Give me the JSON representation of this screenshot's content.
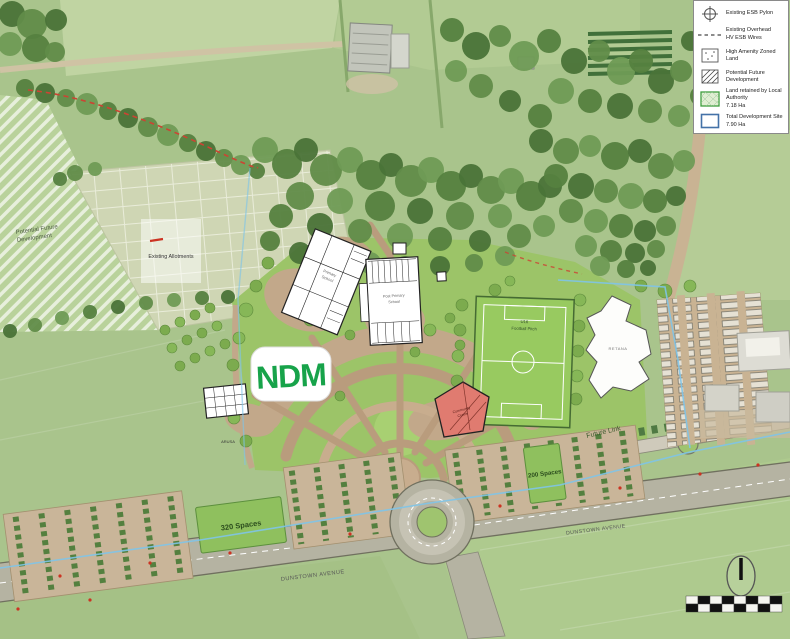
{
  "logo": {
    "text": "NDM"
  },
  "legend": {
    "items": [
      {
        "icon": "esb-pylon-icon",
        "label": "Existing ESB Pylon",
        "sublabel": ""
      },
      {
        "icon": "overhead-wires-icon",
        "label": "Existing Overhead",
        "sublabel": "HV ESB Wires"
      },
      {
        "icon": "high-amenity-icon",
        "label": "High Amenity Zoned Land",
        "sublabel": ""
      },
      {
        "icon": "future-development-icon",
        "label": "Potential Future Development",
        "sublabel": ""
      },
      {
        "icon": "land-retained-icon",
        "label": "Land retained by Local Authority",
        "sublabel": "7.18 Ha"
      },
      {
        "icon": "total-site-icon",
        "label": "Total Development Site",
        "sublabel": "7.90 Ha"
      }
    ]
  },
  "map_labels": {
    "potential_future_line1": "Potential Future",
    "potential_future_line2": "Development",
    "existing_allotments": "Existing Allotments",
    "school1_line1": "Primary",
    "school1_line2": "School",
    "school2_line1": "Post Primary",
    "school2_line2": "School",
    "community_line1": "Community",
    "community_line2": "Centre",
    "pitch_line1": "U16",
    "pitch_line2": "Football Pitch",
    "large_building": "RETANA",
    "small_building": "ARUSA",
    "spaces_west": "320 Spaces",
    "spaces_east": "200 Spaces",
    "future_link": "Future Link",
    "road_name_west": "DUNSTOWN AVENUE",
    "road_name_east": "DUNSTOWN AVENUE"
  },
  "colors": {
    "site_boundary": "#7FC4E8",
    "community_centre": "#E07B70",
    "wire_overlay": "#CC4433",
    "legend_green": "#3F9E3F",
    "legend_blue": "#4472A8",
    "logo_green": "#17A34A"
  }
}
